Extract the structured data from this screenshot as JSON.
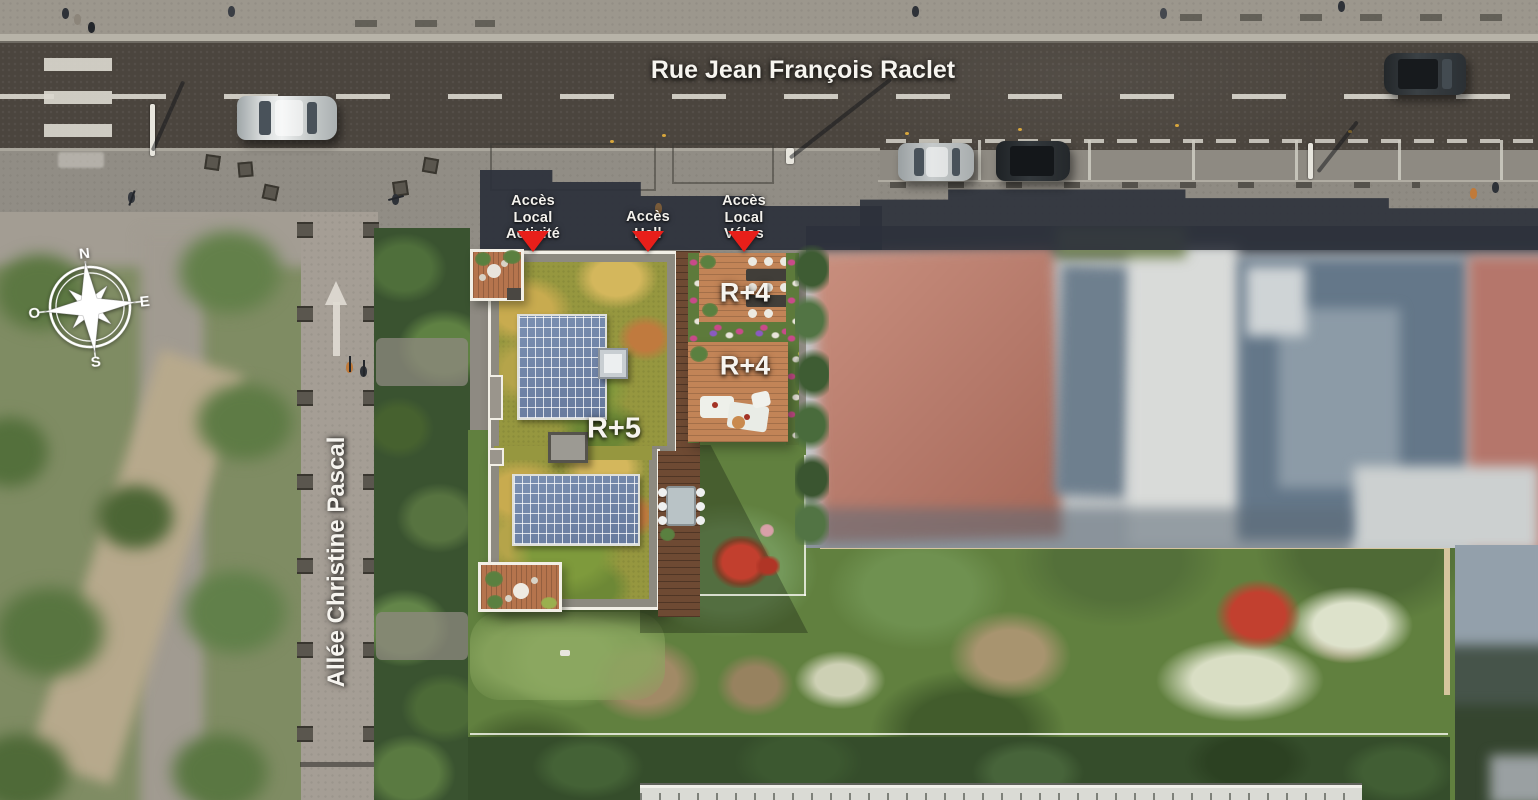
{
  "scene": {
    "title": "Plan masse aérien de la résidence"
  },
  "streets": {
    "main": "Rue Jean François Raclet",
    "alley": "Allée Christine Pascal"
  },
  "access": [
    {
      "label": "Accès\nLocal\nActivité"
    },
    {
      "label": "Accès\nHall"
    },
    {
      "label": "Accès\nLocal\nVélos"
    }
  ],
  "buildings": {
    "r5": "R+5",
    "r4_upper": "R+4",
    "r4_lower": "R+4"
  },
  "compass": {
    "n": "N",
    "e": "E",
    "s": "S",
    "o": "O"
  },
  "colors": {
    "marker_red": "#e81f1a",
    "roof_green": "#96973f",
    "solar_blue": "#7085a8",
    "deck_wood": "#b5744d",
    "shadow_dark": "#2b303b",
    "property_line_tan": "#d6c59e"
  }
}
